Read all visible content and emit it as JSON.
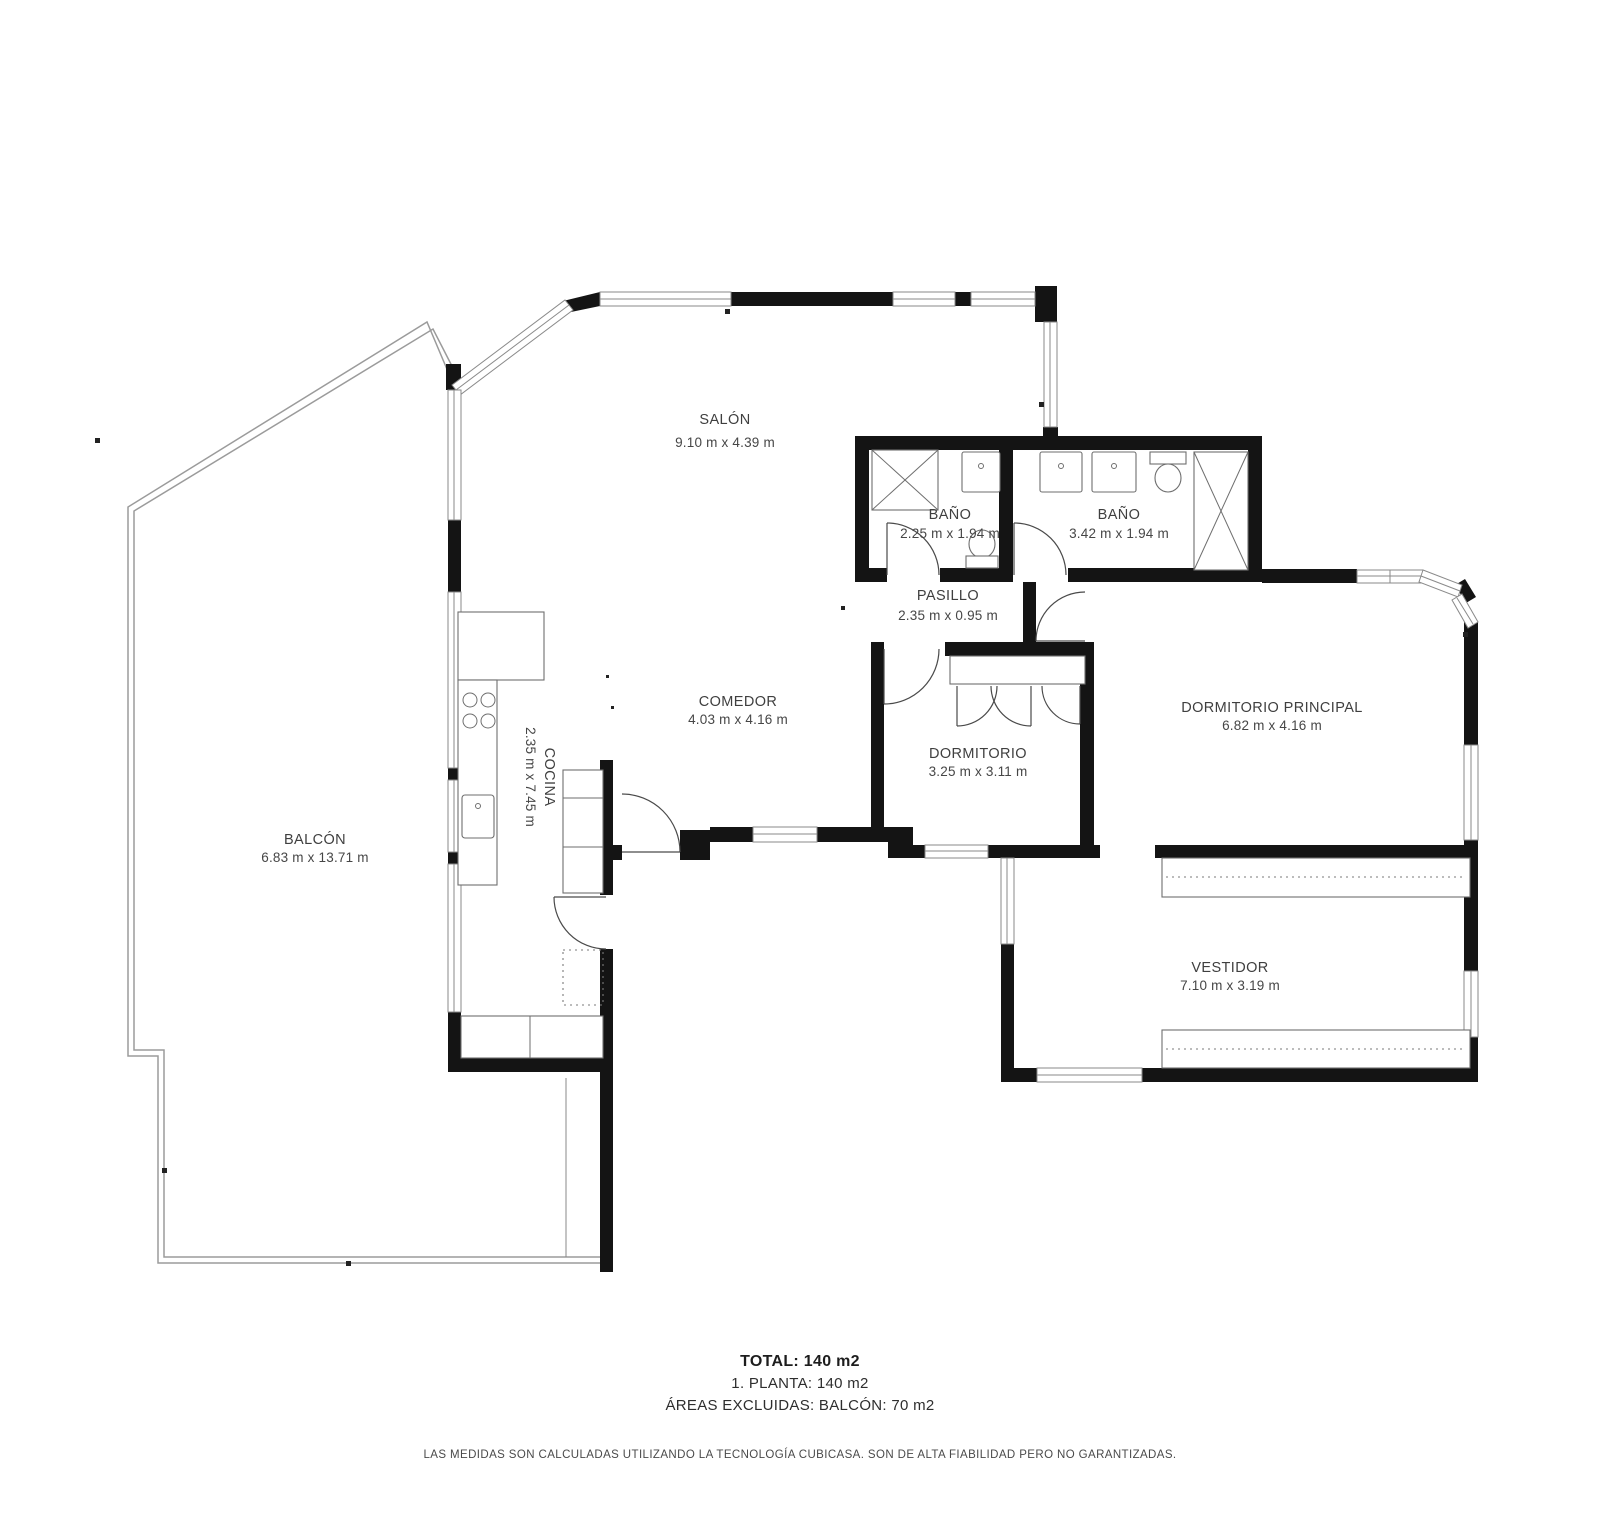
{
  "plan": {
    "rooms": [
      {
        "id": "salon",
        "name": "SALÓN",
        "dims": "9.10 m x 4.39 m"
      },
      {
        "id": "bano-1",
        "name": "BAÑO",
        "dims": "2.25 m x 1.94 m"
      },
      {
        "id": "bano-2",
        "name": "BAÑO",
        "dims": "3.42 m x 1.94 m"
      },
      {
        "id": "pasillo",
        "name": "PASILLO",
        "dims": "2.35 m x 0.95 m"
      },
      {
        "id": "comedor",
        "name": "COMEDOR",
        "dims": "4.03 m x 4.16 m"
      },
      {
        "id": "dormitorio",
        "name": "DORMITORIO",
        "dims": "3.25 m x 3.11 m"
      },
      {
        "id": "dormitorio-principal",
        "name": "DORMITORIO PRINCIPAL",
        "dims": "6.82 m x 4.16 m"
      },
      {
        "id": "cocina",
        "name": "COCINA",
        "dims": "2.35 m x 7.45 m"
      },
      {
        "id": "balcon",
        "name": "BALCÓN",
        "dims": "6.83 m x 13.71 m"
      },
      {
        "id": "vestidor",
        "name": "VESTIDOR",
        "dims": "7.10 m x 3.19 m"
      }
    ],
    "summary": {
      "total": "TOTAL: 140 m2",
      "floor": "1. PLANTA: 140 m2",
      "excluded": "ÁREAS EXCLUIDAS: BALCÓN: 70 m2"
    },
    "disclaimer": "LAS MEDIDAS SON CALCULADAS UTILIZANDO LA TECNOLOGÍA CUBICASA. SON DE ALTA FIABILIDAD PERO NO GARANTIZADAS.",
    "colors": {
      "wall": "#141414",
      "window_line": "#8a8a8a",
      "railing": "#9b9b9b",
      "text": "#3f3f3f"
    }
  }
}
